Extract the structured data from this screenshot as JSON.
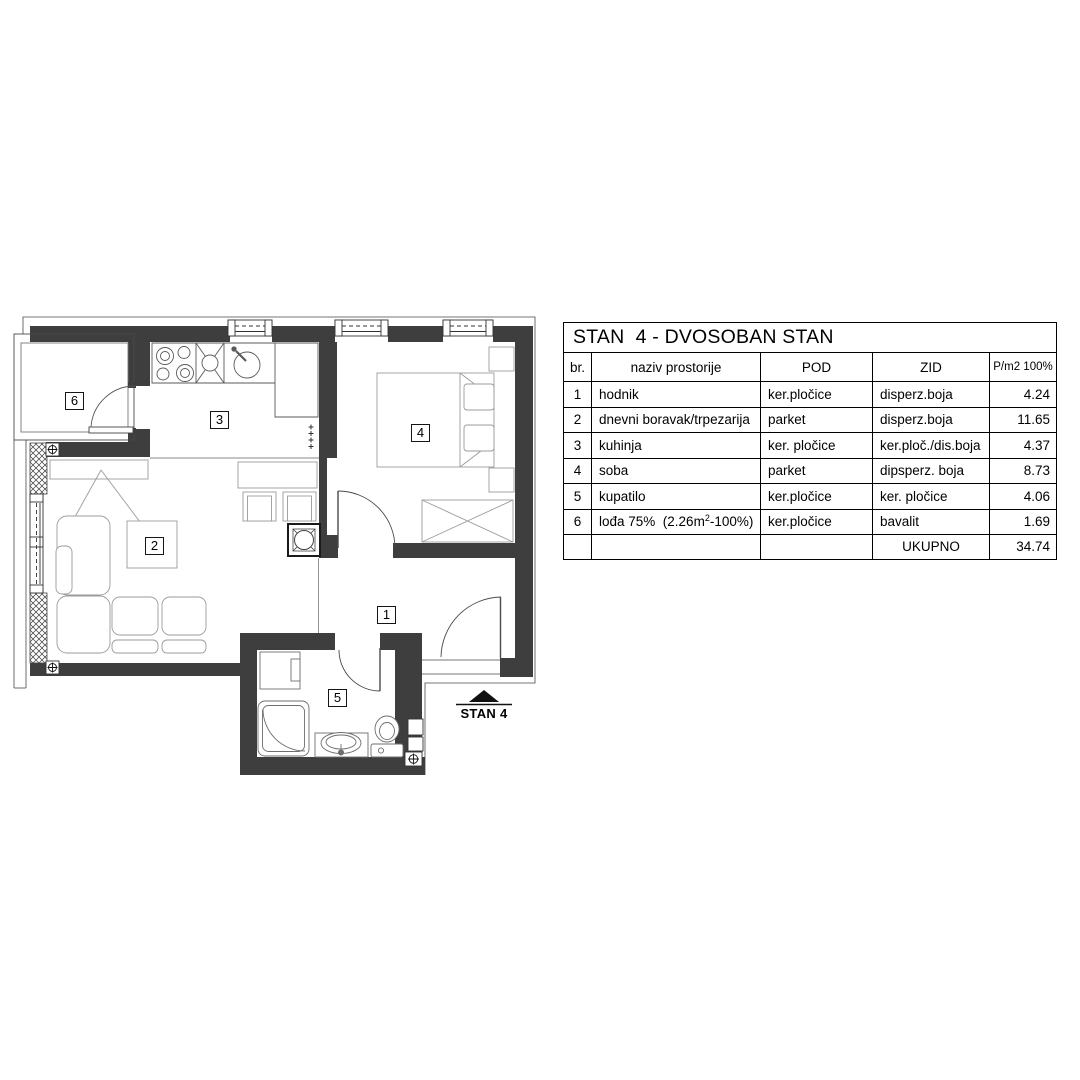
{
  "plan": {
    "labels": {
      "room1": "1",
      "room2": "2",
      "room3": "3",
      "room4": "4",
      "room5": "5",
      "room6": "6"
    },
    "marker_label": "STAN 4",
    "colors": {
      "wall": "#3e3e3e",
      "outline": "#4a4a4a",
      "furniture": "#9b9b9b",
      "fixture": "#6e6e6e"
    }
  },
  "table": {
    "title": "STAN  4 - DVOSOBAN STAN",
    "headers": {
      "br": "br.",
      "naziv": "naziv prostorije",
      "pod": "POD",
      "zid": "ZID",
      "p": "P/m2 100%"
    },
    "rows": [
      {
        "br": "1",
        "naziv": "hodnik",
        "pod": "ker.pločice",
        "zid": "disperz.boja",
        "p": "4.24"
      },
      {
        "br": "2",
        "naziv": "dnevni boravak/trpezarija",
        "pod": "parket",
        "zid": "disperz.boja",
        "p": "11.65"
      },
      {
        "br": "3",
        "naziv": "kuhinja",
        "pod": "ker. pločice",
        "zid": "ker.ploč./dis.boja",
        "p": "4.37"
      },
      {
        "br": "4",
        "naziv": "soba",
        "pod": "parket",
        "zid": "dipsperz. boja",
        "p": "8.73"
      },
      {
        "br": "5",
        "naziv": "kupatilo",
        "pod": "ker.pločice",
        "zid": "ker. pločice",
        "p": "4.06"
      },
      {
        "br": "6",
        "naziv_prefix": "lođa 75%  (2.26m",
        "naziv_sup": "2",
        "naziv_suffix": "-100%)",
        "pod": "ker.pločice",
        "zid": "bavalit",
        "p": "1.69"
      }
    ],
    "total": {
      "label": "UKUPNO",
      "value": "34.74"
    }
  }
}
